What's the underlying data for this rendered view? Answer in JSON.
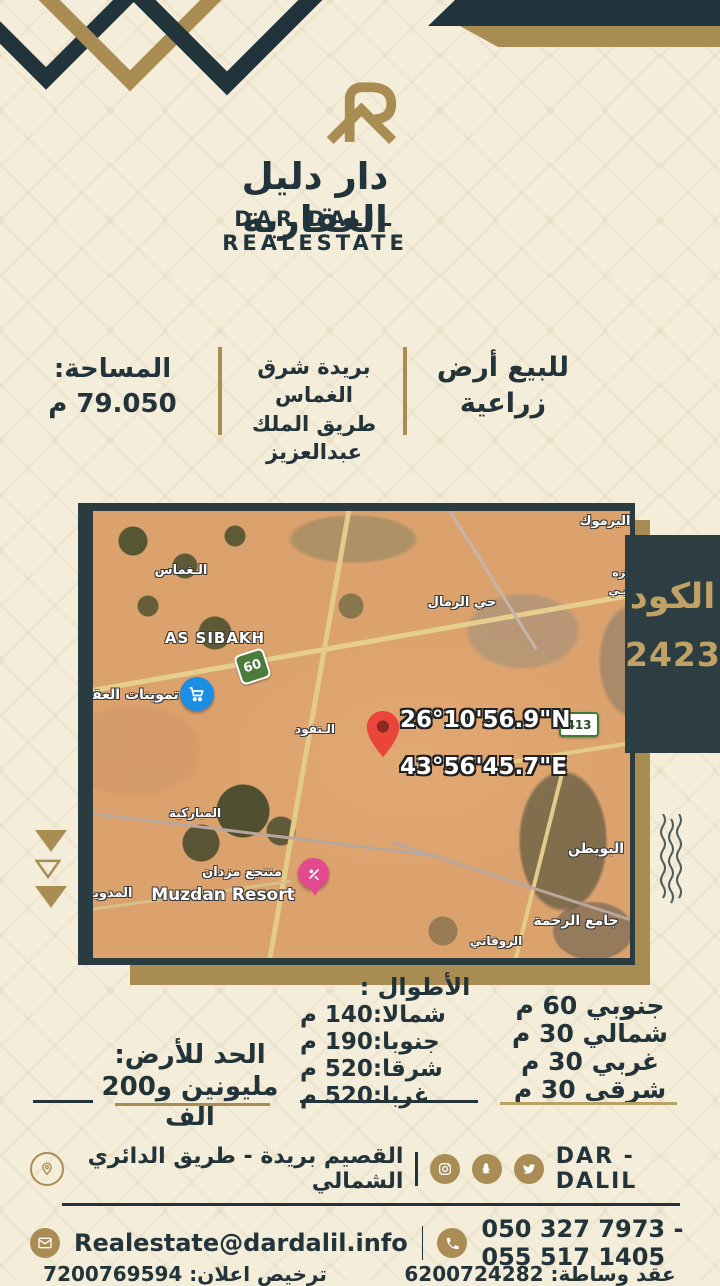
{
  "brand": {
    "logo_icon": "dar-dalil-monogram-icon",
    "name_ar": "دار دليل العقارية",
    "name_en": "DAR DALIL REALESTATE"
  },
  "listing": {
    "type_line1": "للبيع أرض",
    "type_line2": "زراعية",
    "location_line1": "بريدة شرق الغماس",
    "location_line2": "طريق الملك عبدالعزيز",
    "area_label": "المساحة:",
    "area_value": "79.050 م"
  },
  "code": {
    "label": "الكود",
    "value": "2423"
  },
  "map": {
    "coordinates": {
      "lat": "26°10'56.9\"N",
      "lng": "43°56'45.7\"E"
    },
    "shields": [
      "60",
      "413"
    ],
    "labels": [
      "الـغماس",
      "AS SIBAKH",
      "حي الرمال",
      "اليرموك",
      "تزه",
      "يـي",
      "تموينات العقـ",
      "الـنفود",
      "المباركية",
      "منتجع مزدان",
      "Muzdan Resort",
      "المدويـ",
      "البويطن",
      "جامع الرحمة",
      "الروفاني"
    ],
    "poi_icons": [
      "cart-icon",
      "resort-icon",
      "red-location-pin-icon"
    ]
  },
  "dimensions": {
    "title": "الأطوال :",
    "lengths": [
      "شمالا:140 م",
      "جنوبا:190 م",
      "شرقا:520 م",
      "غربا:520 م"
    ],
    "sides": [
      "جنوبي 60 م",
      "شمالي 30 م",
      "غربي 30 م",
      "شرقي 30 م"
    ]
  },
  "price": {
    "label": "الحد للأرض:",
    "value": "مليونين و200 الف"
  },
  "footer": {
    "company": "DAR - DALIL",
    "address": "القصيم بريدة - طريق الدائري الشمالي",
    "email": "Realestate@dardalil.info",
    "phones": "050 327 7973 - 055 517 1405",
    "brokerage": "عقد وساطة: 6200724282",
    "license": "ترخيص اعلان: 7200769594",
    "social_icons": [
      "instagram-icon",
      "snapchat-icon",
      "twitter-icon"
    ],
    "contact_icons": [
      "location-pin-icon",
      "envelope-icon",
      "phone-icon"
    ]
  },
  "colors": {
    "background": "#f3edda",
    "dark_teal": "#22343b",
    "gold": "#a98c52",
    "badge_bg": "#2c3e42",
    "badge_text": "#c2a264",
    "map_sand": "#dca26e",
    "pin_red": "#e9453b"
  }
}
